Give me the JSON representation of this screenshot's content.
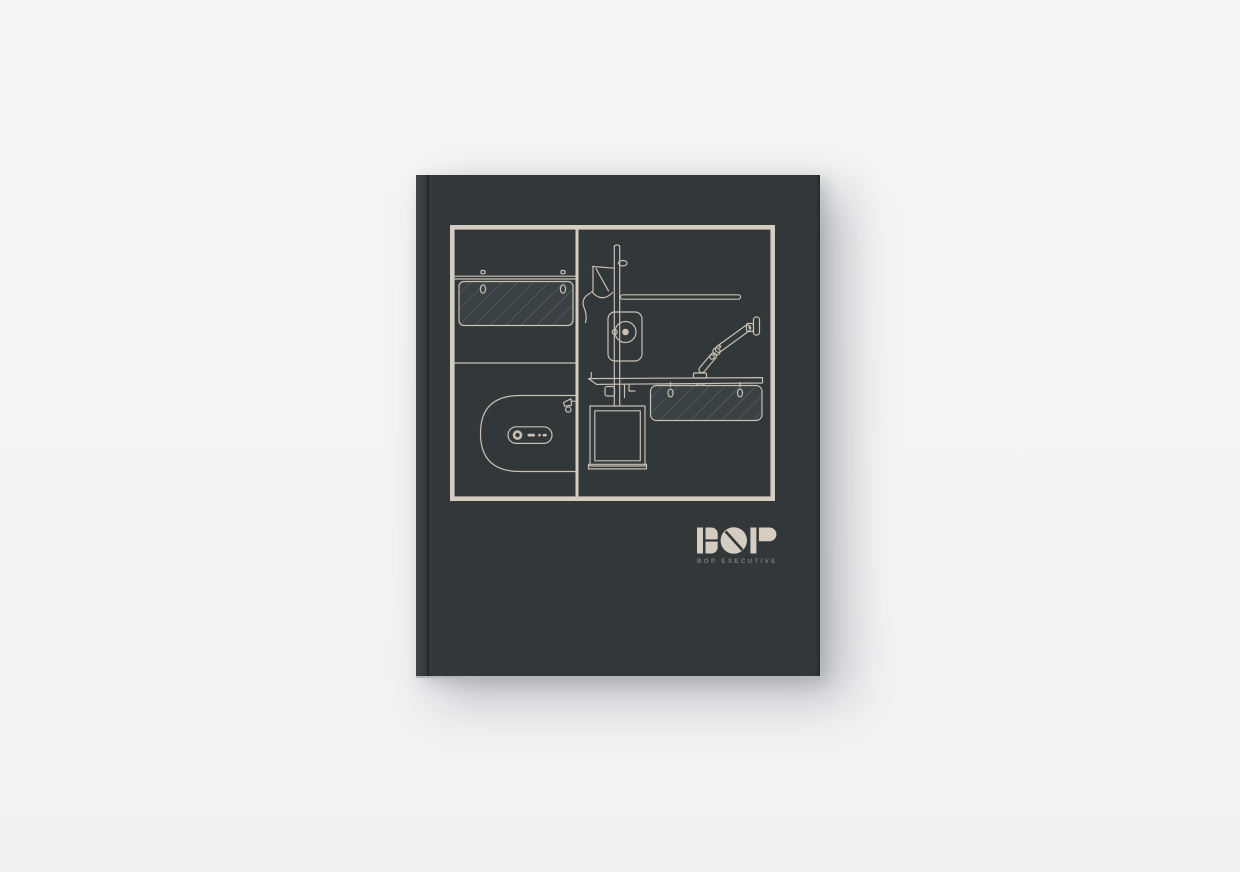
{
  "scene": {
    "type": "book-cover-mockup",
    "backdrop": "plain light studio background"
  },
  "colors": {
    "page_bg": "#f4f4f6",
    "cover": "#323839",
    "cover_panel": "#3a4144",
    "accent": "#d6cdc2",
    "line": "#c8bfb5",
    "hatch": "#8d8a84",
    "tagline": "#7d7a74",
    "page_edge": "#b6b7ba"
  },
  "book": {
    "brand": {
      "logo_text": "BOP",
      "tagline": "BOP EXECUTIVE"
    },
    "cover_art": {
      "style": "technical blueprint line drawing of modular office furniture, beige lines on charcoal",
      "layout": "framed rectangle split into two columns; left column split into two rows",
      "elements": [
        "wall rail with hooks",
        "hanging acoustic screen with diagonal hatching",
        "desk top view with rounded end",
        "inline power module with socket",
        "desk clamp detail",
        "support pole with task lamp and trailing cable",
        "cantilever beam rail",
        "pole-mounted storage panel with knob",
        "desk side profile",
        "articulated monitor arm with VESA plate",
        "under-desk hatched modesty panel with hooks",
        "suspended storage box"
      ]
    }
  }
}
